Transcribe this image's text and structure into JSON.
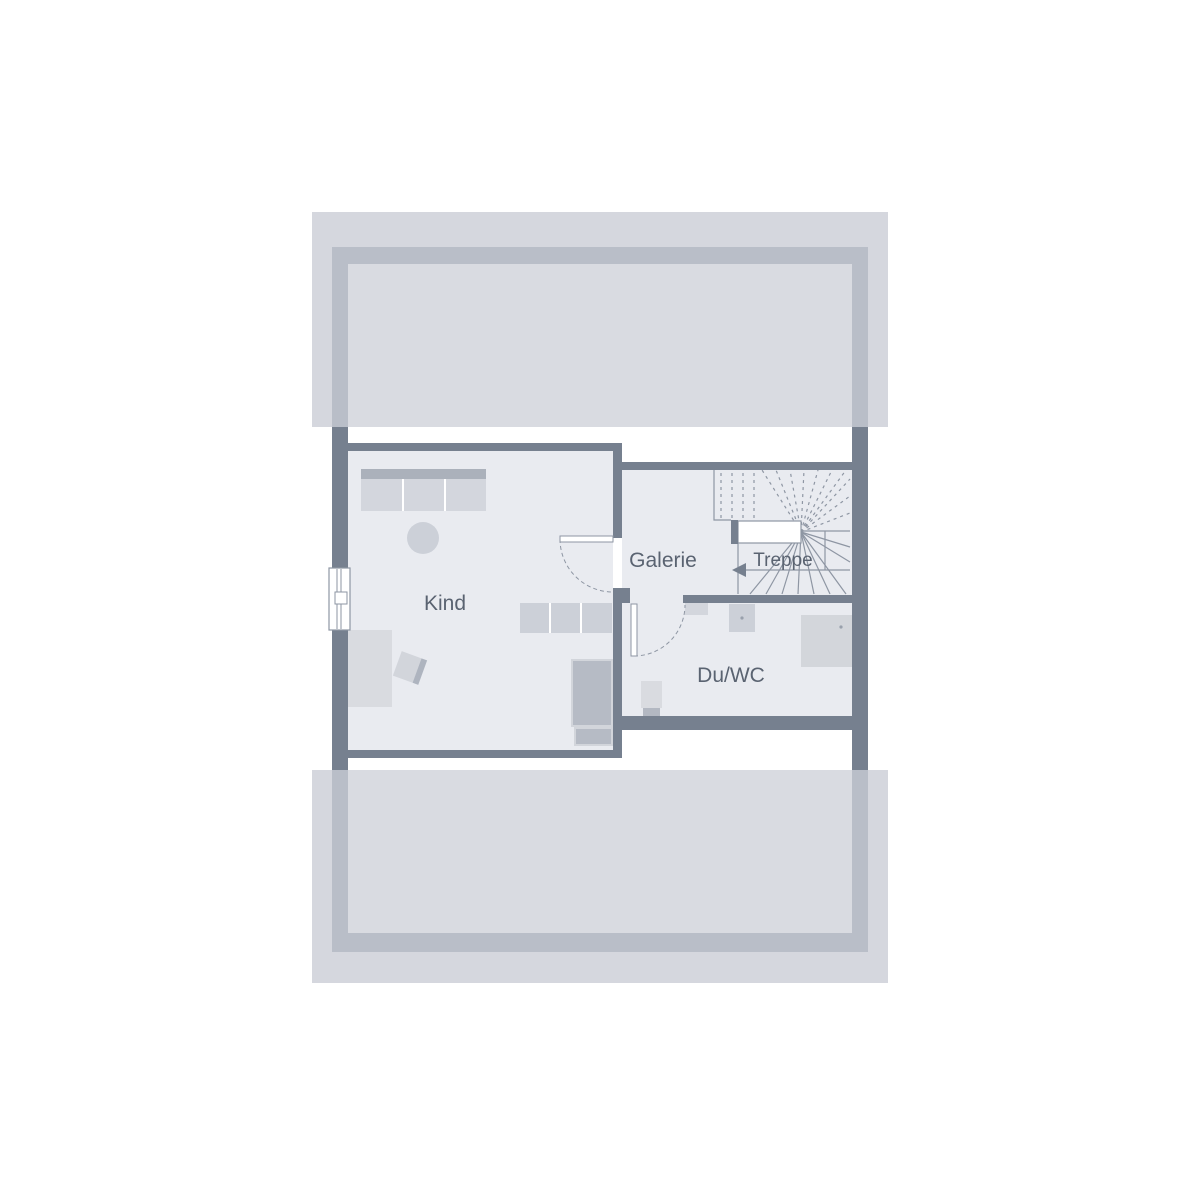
{
  "rooms": {
    "kind": {
      "label": "Kind"
    },
    "galerie": {
      "label": "Galerie"
    },
    "treppe": {
      "label": "Treppe"
    },
    "duwc": {
      "label": "Du/WC"
    }
  },
  "colors": {
    "wall": "#76808f",
    "roof_overhang": "#d5d7de",
    "roof_frame": "#b9bec8",
    "roof_inner": "#d9dbe1",
    "floor": "#e9ebf0",
    "furniture_light": "#d3d6dd",
    "furniture_medium": "#b6bbc5",
    "stair_line": "#8e96a3",
    "label_text": "#5a6371"
  }
}
